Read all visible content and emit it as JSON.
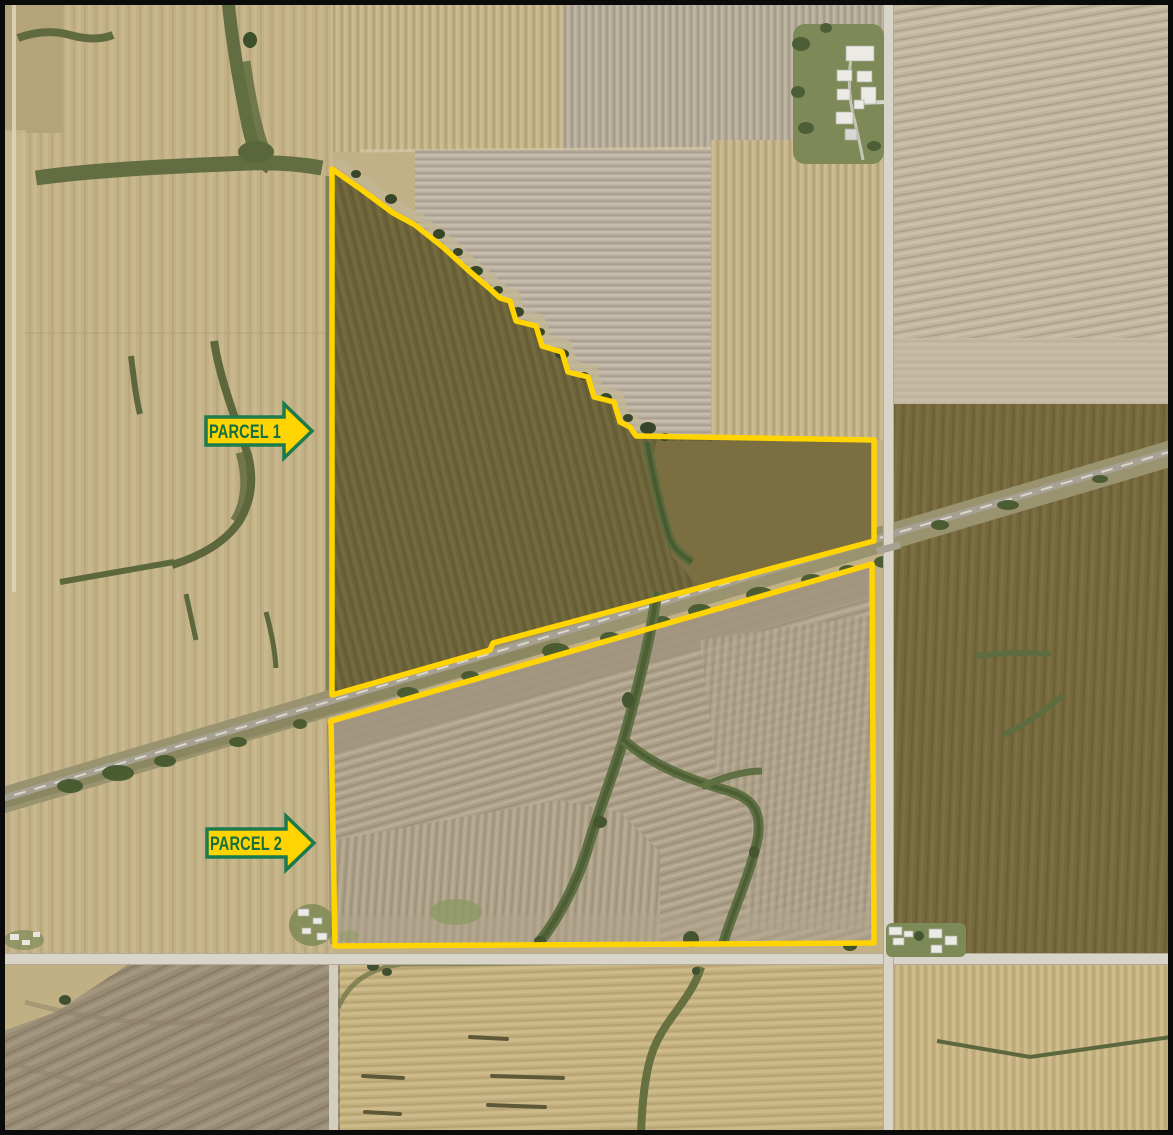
{
  "map": {
    "annotations": [
      {
        "label": "PARCEL 1"
      },
      {
        "label": "PARCEL 2"
      }
    ]
  },
  "colors": {
    "parcel_outline": "#FFD400",
    "arrow_fill": "#FFD400",
    "arrow_border": "#1C7A4D",
    "arrow_text": "#156F45"
  }
}
